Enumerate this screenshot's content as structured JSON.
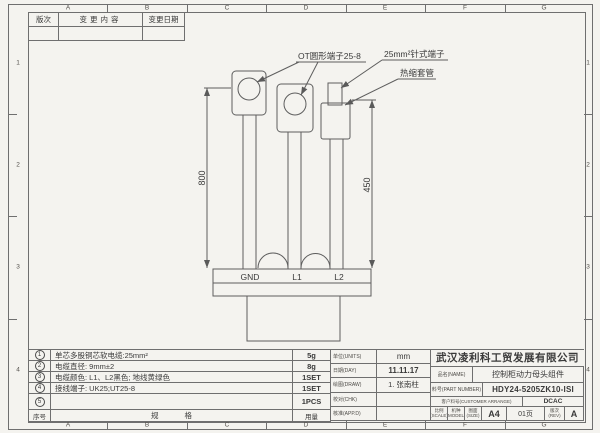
{
  "sheet": {
    "zones_top": [
      "A",
      "B",
      "C",
      "D",
      "E",
      "F",
      "G"
    ],
    "zones_bottom": [
      "A",
      "B",
      "C",
      "D",
      "E",
      "F",
      "G"
    ],
    "zones_left": [
      "1",
      "2",
      "3",
      "4"
    ],
    "zones_right": [
      "1",
      "2",
      "3",
      "4"
    ]
  },
  "revision_table": {
    "col_rev": "版次",
    "col_content": "变更内容",
    "col_date": "变更日期"
  },
  "drawing": {
    "callout_ot_terminal": "OT圆形端子25-8",
    "callout_pin_terminal": "25mm²针式端子",
    "callout_heat_shrink": "热缩套管",
    "dim_left": "800",
    "dim_right": "450",
    "wire_labels": [
      "GND",
      "L1",
      "L2"
    ]
  },
  "bom": {
    "rows": [
      {
        "no": "1",
        "desc": "单芯多股铜芯软电缆:25mm²",
        "qty": "5g"
      },
      {
        "no": "2",
        "desc": "电缆直径: 9mm±2",
        "qty": "8g"
      },
      {
        "no": "3",
        "desc": "电缆颜色: L1、L2黑色; 地线黄绿色",
        "qty": "1SET"
      },
      {
        "no": "4",
        "desc": "接线端子: UK25;UT25-8",
        "qty": "1SET"
      },
      {
        "no": "5",
        "desc": "",
        "qty": "1PCS"
      }
    ],
    "footer_no": "序号",
    "footer_spec": "规格",
    "footer_qty": "用量"
  },
  "title_block": {
    "company": "武汉凌利科工贸发展有限公司",
    "units_label": "单位(UNITS)",
    "units_value": "mm",
    "date_label": "日期(DAY)",
    "date_value": "11.11.17",
    "draw_label": "绘图(DRAW)",
    "draw_value": "1. 张南柱",
    "check_label": "校对(CHK)",
    "check_value": "",
    "approve_label": "核准(APP.D)",
    "approve_value": "",
    "name_label": "品名(NAME)",
    "name_value": "控制柜动力母头组件",
    "part_label": "料号(PART NUMBER)",
    "part_value": "HDY24-5205ZK10-ISI",
    "customer_label": "客户料号(CUSTOMER ARRANGE)",
    "customer_value": "DCAC",
    "scale_label": "比例(SCALE)",
    "model_label": "机种(MODEL)",
    "size_label": "图面(SIZE)",
    "size_value": "A4",
    "page_value": "01页",
    "rev_label": "版次(REV)",
    "rev_value": "A"
  },
  "colors": {
    "paper": "#f4f3ef",
    "line": "#6f6f6f",
    "text": "#3a3a3a"
  }
}
